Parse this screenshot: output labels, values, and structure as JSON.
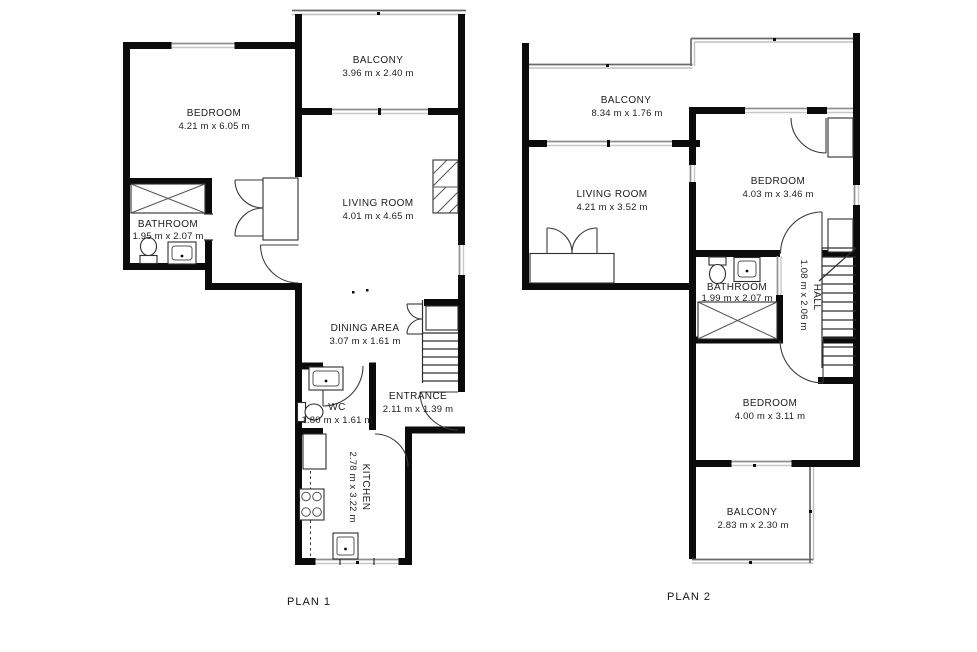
{
  "colors": {
    "background": "#ffffff",
    "wall": "#0b0b0b",
    "window": "#8f8f8f",
    "text": "#1c1c1c"
  },
  "plans": {
    "plan1": {
      "label": "PLAN 1",
      "rooms": {
        "balcony": {
          "name": "BALCONY",
          "dims": "3.96 m x 2.40 m"
        },
        "bedroom": {
          "name": "BEDROOM",
          "dims": "4.21 m x 6.05 m"
        },
        "bathroom": {
          "name": "BATHROOM",
          "dims": "1.95 m x 2.07 m"
        },
        "living_room": {
          "name": "LIVING ROOM",
          "dims": "4.01 m x 4.65 m"
        },
        "dining_area": {
          "name": "DINING AREA",
          "dims": "3.07 m x 1.61 m"
        },
        "wc": {
          "name": "WC",
          "dims": "1.80 m x 1.61 m"
        },
        "entrance": {
          "name": "ENTRANCE",
          "dims": "2.11 m x 1.39 m"
        },
        "kitchen": {
          "name": "KITCHEN",
          "dims": "2.78 m x 3.22 m"
        }
      }
    },
    "plan2": {
      "label": "PLAN 2",
      "rooms": {
        "balcony_top": {
          "name": "BALCONY",
          "dims": "8.34 m x 1.76 m"
        },
        "living_room": {
          "name": "LIVING ROOM",
          "dims": "4.21 m x 3.52 m"
        },
        "bedroom_top": {
          "name": "BEDROOM",
          "dims": "4.03 m x 3.46 m"
        },
        "bathroom": {
          "name": "BATHROOM",
          "dims": "1.99 m x 2.07 m"
        },
        "hall": {
          "name": "HALL",
          "dims": "1.08 m x 2.06 m"
        },
        "bedroom_bottom": {
          "name": "BEDROOM",
          "dims": "4.00 m x 3.11 m"
        },
        "balcony_bottom": {
          "name": "BALCONY",
          "dims": "2.83 m x 2.30 m"
        }
      }
    }
  }
}
